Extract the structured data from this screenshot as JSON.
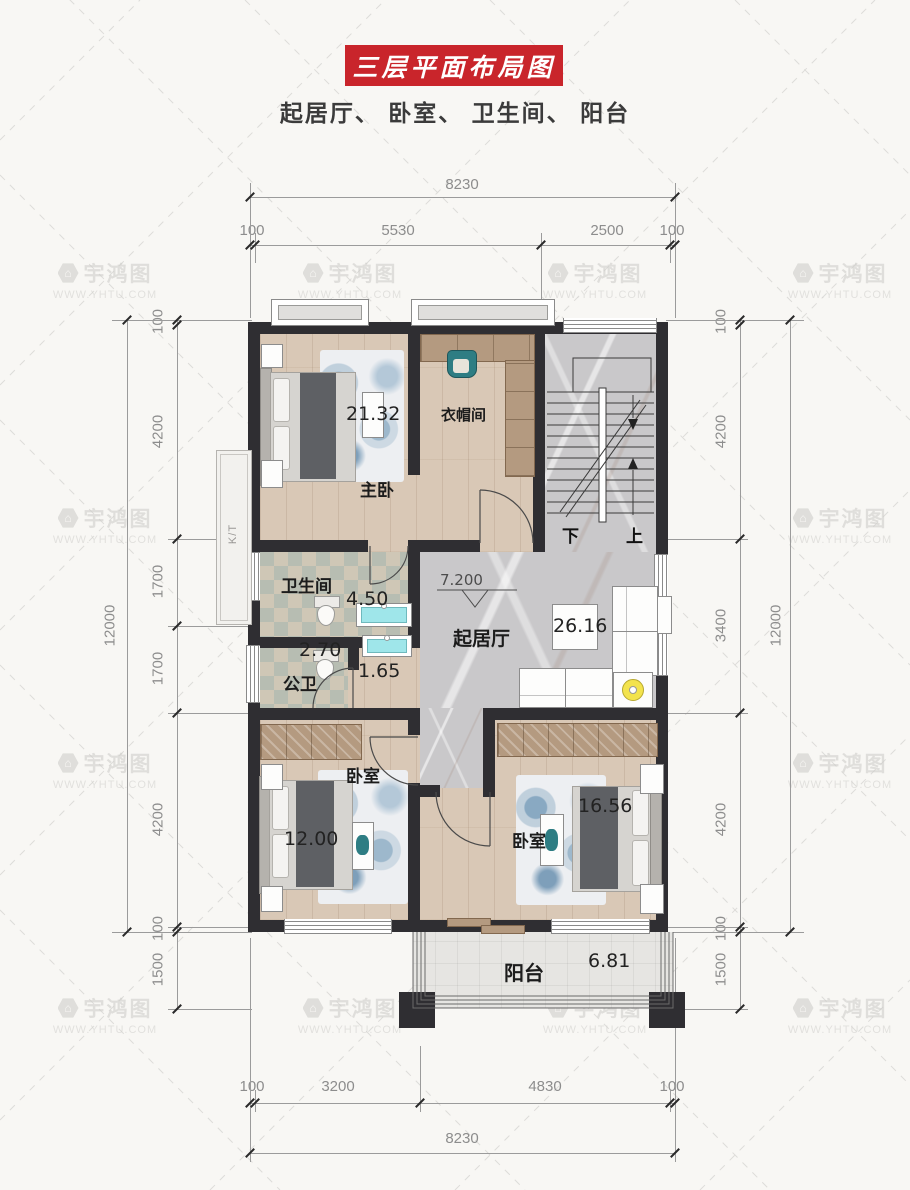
{
  "header": {
    "banner": "三层平面布局图",
    "subtitle": "起居厅、 卧室、 卫生间、 阳台"
  },
  "watermark": {
    "brand": "宇鸿图",
    "url": "WWW.YHTU.COM"
  },
  "dims": {
    "top": {
      "overall": "8230",
      "segs": [
        "100",
        "5530",
        "2500",
        "100"
      ]
    },
    "bottom": {
      "overall": "8230",
      "segs": [
        "100",
        "3200",
        "4830",
        "100"
      ]
    },
    "left": {
      "overall": "12000",
      "segs": [
        "100",
        "4200",
        "1700",
        "1700",
        "4200",
        "100",
        "1500"
      ]
    },
    "right": {
      "overall": "12000",
      "segs": [
        "100",
        "4200",
        "3400",
        "4200",
        "100",
        "1500"
      ]
    }
  },
  "rooms": {
    "master": {
      "label": "主卧",
      "area": "21.32"
    },
    "cloak": {
      "label": "衣帽间"
    },
    "bath": {
      "label": "卫生间",
      "area": "4.50"
    },
    "publicBath": {
      "label": "公卫",
      "area": "2.70"
    },
    "vanity": {
      "area": "1.65"
    },
    "living": {
      "label": "起居厅",
      "area": "26.16",
      "level": "7.200"
    },
    "bedroom1": {
      "label": "卧室",
      "area": "12.00"
    },
    "bedroom2": {
      "label": "卧室",
      "area": "16.56"
    },
    "balcony": {
      "label": "阳台",
      "area": "6.81"
    }
  },
  "stairs": {
    "down": "下",
    "up": "上"
  },
  "ac": {
    "label": "K/T"
  },
  "colors": {
    "accent": "#c9252b",
    "wall": "#2f2e32",
    "teal": "#2e7d83",
    "sink": "#9fe6ea"
  }
}
